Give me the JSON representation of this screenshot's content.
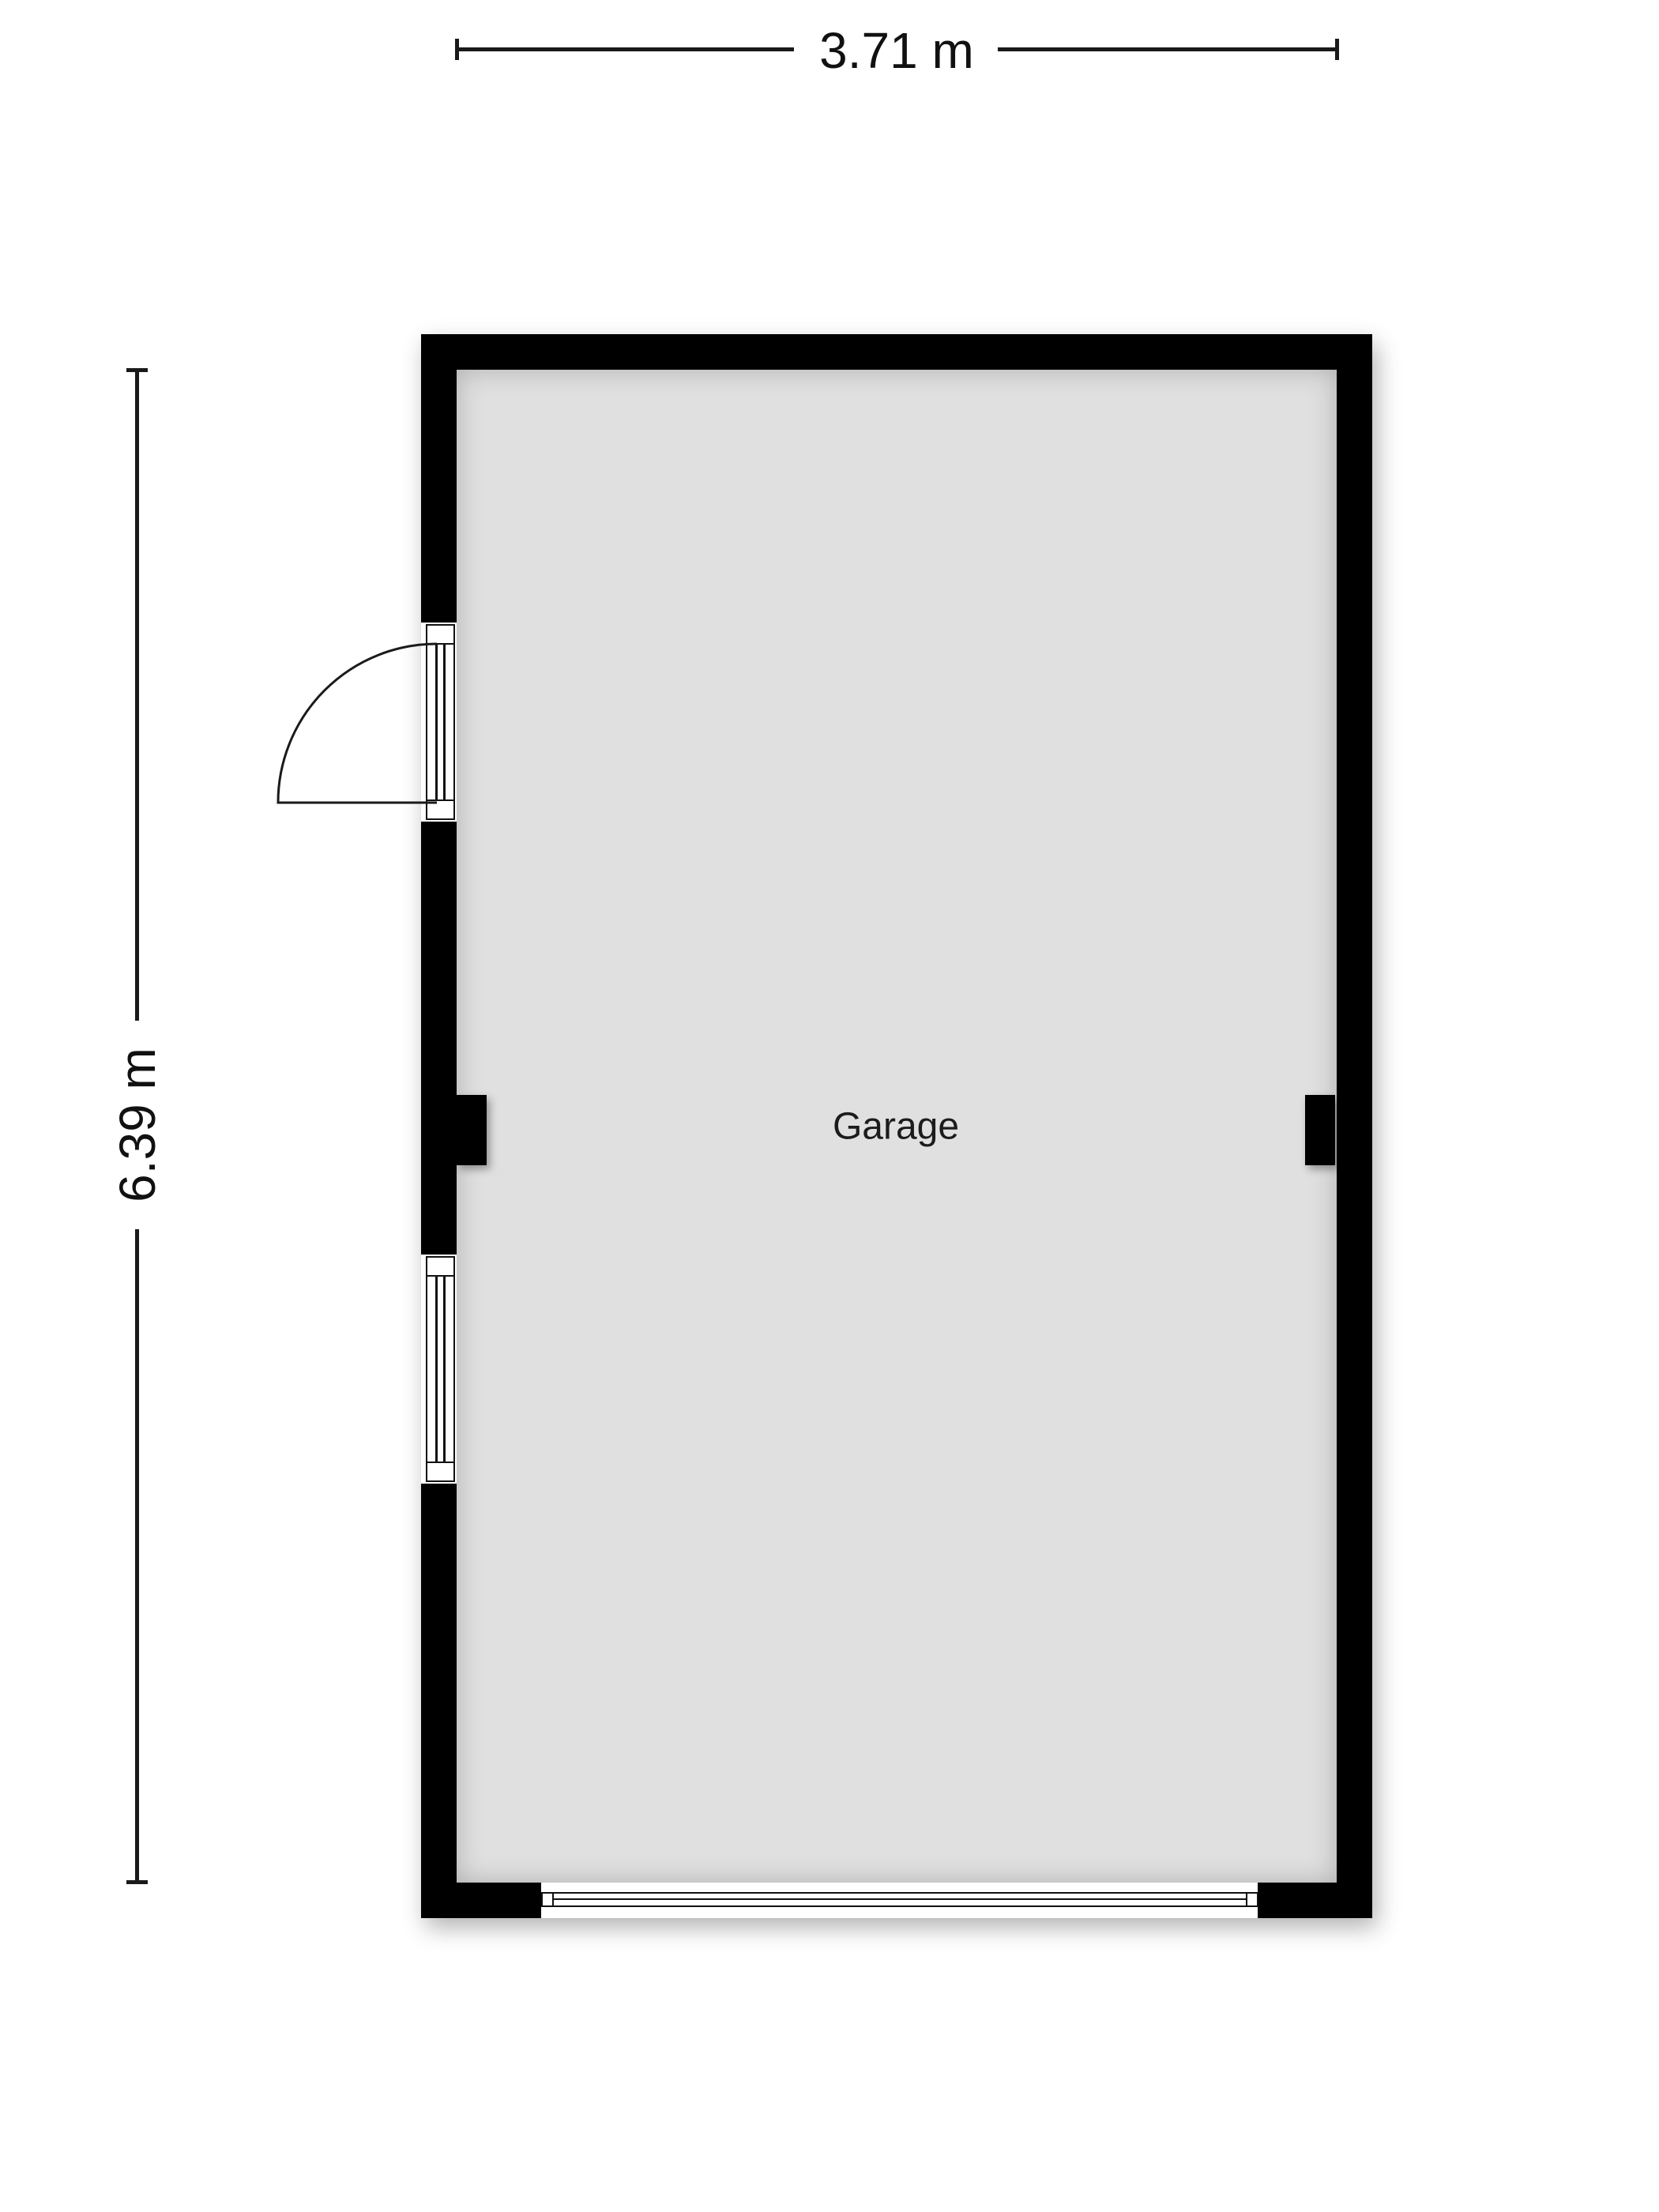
{
  "plan": {
    "room_label": "Garage",
    "dim_width_label": "3.71 m",
    "dim_height_label": "6.39 m",
    "colors": {
      "wall": "#000000",
      "floor": "#e0e0e0",
      "line": "#1a1a1a",
      "text": "#111111",
      "background": "#ffffff"
    }
  }
}
